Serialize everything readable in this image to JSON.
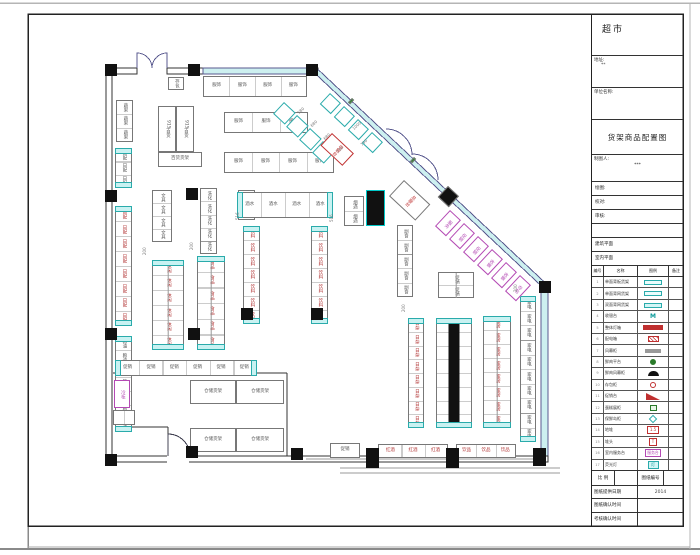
{
  "sheet": {
    "store_type": "超市",
    "address_label": "地址:",
    "address_value": "**",
    "org_label": "单位名称:",
    "org_value": "",
    "drawing_title": "货架商品配置图",
    "drafter_label": "制图人:",
    "drafter_value": "***",
    "rows": [
      {
        "label": "绘图:"
      },
      {
        "label": "校对:"
      },
      {
        "label": "审核:"
      },
      {
        "label": ""
      },
      {
        "label": "建筑平面"
      },
      {
        "label": "室内平面"
      }
    ],
    "scale_label": "比 例",
    "scale_value": "",
    "sheet_no_label": "图纸编号",
    "sheet_no_value": "",
    "date_rows": [
      {
        "label": "图纸提供日期",
        "value": "2014"
      },
      {
        "label": "图纸确认时间",
        "value": ""
      },
      {
        "label": "考核确认时间",
        "value": ""
      }
    ]
  },
  "legend": {
    "headers": [
      "编号",
      "名称",
      "图例",
      "备注"
    ],
    "rows": [
      {
        "no": "1",
        "name": "单面背板货架",
        "sym": "s-rect",
        "symtext": ""
      },
      {
        "no": "2",
        "name": "单面背网货架",
        "sym": "s-rect",
        "symtext": ""
      },
      {
        "no": "3",
        "name": "双面背网货架",
        "sym": "s-rect2",
        "symtext": ""
      },
      {
        "no": "4",
        "name": "收银台",
        "sym": "s-m",
        "symtext": "M"
      },
      {
        "no": "5",
        "name": "整体灯箱",
        "sym": "s-barred",
        "symtext": ""
      },
      {
        "no": "6",
        "name": "配电箱",
        "sym": "s-boxx",
        "symtext": ""
      },
      {
        "no": "7",
        "name": "风幕柜",
        "sym": "s-bargray",
        "symtext": ""
      },
      {
        "no": "8",
        "name": "鲜肉平台",
        "sym": "s-circg",
        "symtext": ""
      },
      {
        "no": "9",
        "name": "鲜肉风幕柜",
        "sym": "s-fan",
        "symtext": ""
      },
      {
        "no": "10",
        "name": "存包柜",
        "sym": "s-circr",
        "symtext": ""
      },
      {
        "no": "11",
        "name": "促销台",
        "sym": "s-wedge",
        "symtext": ""
      },
      {
        "no": "12",
        "name": "蛋糕展柜",
        "sym": "s-boxg",
        "symtext": ""
      },
      {
        "no": "13",
        "name": "保鲜岛柜",
        "sym": "s-diam",
        "symtext": ""
      },
      {
        "no": "14",
        "name": "地堆",
        "sym": "s-box15",
        "symtext": "1.5"
      },
      {
        "no": "15",
        "name": "堆头",
        "sym": "s-boxt",
        "symtext": "T"
      },
      {
        "no": "16",
        "name": "室内服务台",
        "sym": "s-boxm",
        "symtext": "服务台"
      },
      {
        "no": "17",
        "name": "荧光灯",
        "sym": "s-pill",
        "symtext": "灯"
      }
    ]
  },
  "plan": {
    "colors": {
      "cyan": "#2aabab",
      "red": "#c03030",
      "magenta": "#b44ab4",
      "glass": "#cdf0f0",
      "wallline": "#5a5a8f"
    },
    "shelves": [
      {
        "x": 168,
        "y": 77,
        "w": 16,
        "h": 13,
        "label": "存包",
        "n": "locker-unit"
      },
      {
        "x": 203,
        "y": 76,
        "w": 104,
        "h": 21,
        "dir": "h",
        "cells": 4,
        "each": "服饰",
        "n": "apparel-wall-row"
      },
      {
        "x": 116,
        "y": 100,
        "w": 17,
        "h": 42,
        "cells": 3,
        "each": "蔬果",
        "n": "produce-rack"
      },
      {
        "x": 158,
        "y": 106,
        "w": 18,
        "h": 46,
        "label": "915百货",
        "n": "gondola-915"
      },
      {
        "x": 176,
        "y": 106,
        "w": 18,
        "h": 46,
        "label": "915百货",
        "n": "gondola-915"
      },
      {
        "x": 158,
        "y": 152,
        "w": 44,
        "h": 15,
        "dir": "h",
        "label": "百货货架",
        "n": "gondola"
      },
      {
        "x": 224,
        "y": 112,
        "w": 84,
        "h": 21,
        "dir": "h",
        "cells": 3,
        "each": "服饰",
        "n": "apparel-row"
      },
      {
        "x": 224,
        "y": 152,
        "w": 110,
        "h": 21,
        "dir": "h",
        "cells": 4,
        "each": "服饰",
        "n": "apparel-row"
      },
      {
        "x": 115,
        "y": 148,
        "w": 17,
        "h": 40,
        "cells": 3,
        "each": "日配",
        "cap": 1,
        "n": "wall-run"
      },
      {
        "x": 115,
        "y": 206,
        "w": 17,
        "h": 120,
        "cells": 8,
        "each": "日配",
        "cap": 1,
        "lc": "#b03030",
        "n": "wall-run"
      },
      {
        "x": 115,
        "y": 336,
        "w": 17,
        "h": 96,
        "cells": 7,
        "each": "粮油",
        "cap": 1,
        "n": "wall-run"
      },
      {
        "x": 152,
        "y": 190,
        "w": 20,
        "h": 52,
        "cells": 4,
        "each": "文具",
        "n": "gondola"
      },
      {
        "x": 238,
        "y": 190,
        "w": 17,
        "h": 30,
        "cells": 2,
        "each": "玩具",
        "n": "gondola"
      },
      {
        "x": 200,
        "y": 188,
        "w": 17,
        "h": 66,
        "cells": 5,
        "each": "洗化",
        "n": "gondola"
      },
      {
        "x": 152,
        "y": 260,
        "w": 32,
        "h": 90,
        "cells": 6,
        "dbl": 1,
        "cap": 1,
        "each": "休闲",
        "lc": "#b03030",
        "n": "gondola-double"
      },
      {
        "x": 197,
        "y": 256,
        "w": 28,
        "h": 94,
        "cells": 6,
        "dbl": 1,
        "cap": 1,
        "each": "食品",
        "lc": "#b03030",
        "n": "gondola-double"
      },
      {
        "x": 237,
        "y": 192,
        "w": 96,
        "h": 26,
        "dir": "h",
        "cells": 4,
        "cap": 1,
        "each": "酒水",
        "n": "gondola-top-bar"
      },
      {
        "x": 243,
        "y": 226,
        "w": 17,
        "h": 98,
        "cells": 7,
        "cap": 1,
        "each": "饮料",
        "lc": "#b03030",
        "n": "gondola"
      },
      {
        "x": 311,
        "y": 226,
        "w": 17,
        "h": 98,
        "cells": 7,
        "cap": 1,
        "each": "饮料",
        "lc": "#b03030",
        "n": "gondola"
      },
      {
        "x": 397,
        "y": 225,
        "w": 16,
        "h": 72,
        "cells": 5,
        "each": "副食",
        "n": "gondola"
      },
      {
        "x": 438,
        "y": 272,
        "w": 36,
        "h": 26,
        "cells": 2,
        "dbl": 1,
        "each": "促销",
        "n": "promo-table"
      },
      {
        "x": 408,
        "y": 318,
        "w": 16,
        "h": 110,
        "cells": 8,
        "cap": 1,
        "each": "日杂",
        "lc": "#b03030",
        "n": "gondola"
      },
      {
        "x": 436,
        "y": 318,
        "w": 36,
        "h": 110,
        "cells": 8,
        "dbl": 1,
        "mid": "black",
        "cap": 1,
        "each": "五金",
        "lc": "#b03030",
        "n": "gondola-column-run"
      },
      {
        "x": 483,
        "y": 316,
        "w": 28,
        "h": 112,
        "cells": 8,
        "dbl": 1,
        "cap": 1,
        "each": "家居",
        "lc": "#b03030",
        "n": "gondola-double"
      },
      {
        "x": 520,
        "y": 296,
        "w": 16,
        "h": 146,
        "cells": 10,
        "cap": 1,
        "each": "家电",
        "n": "wall-run-right"
      },
      {
        "x": 115,
        "y": 360,
        "w": 142,
        "h": 16,
        "dir": "h",
        "cells": 6,
        "cap": 1,
        "each": "促销",
        "n": "back-row"
      },
      {
        "x": 378,
        "y": 444,
        "w": 70,
        "h": 14,
        "dir": "h",
        "cells": 3,
        "each": "红酒",
        "lc": "#b03030",
        "n": "bottom-row"
      },
      {
        "x": 456,
        "y": 444,
        "w": 60,
        "h": 14,
        "dir": "h",
        "cells": 3,
        "each": "饮品",
        "lc": "#b03030",
        "n": "bottom-row"
      },
      {
        "x": 330,
        "y": 443,
        "w": 30,
        "h": 15,
        "dir": "h",
        "label": "促销",
        "n": "bottom-unit"
      },
      {
        "x": 190,
        "y": 380,
        "w": 46,
        "h": 24,
        "dir": "h",
        "label": "仓储货架",
        "n": "storage-rack"
      },
      {
        "x": 236,
        "y": 380,
        "w": 48,
        "h": 24,
        "dir": "h",
        "label": "仓储货架",
        "n": "storage-rack"
      },
      {
        "x": 190,
        "y": 428,
        "w": 46,
        "h": 24,
        "dir": "h",
        "label": "仓储货架",
        "n": "storage-rack"
      },
      {
        "x": 236,
        "y": 428,
        "w": 48,
        "h": 24,
        "dir": "h",
        "label": "仓储货架",
        "n": "storage-rack"
      },
      {
        "x": 114,
        "y": 380,
        "w": 16,
        "h": 28,
        "label": "冷柜",
        "bc": "#b44ab4",
        "lc": "#b44ab4",
        "n": "cold-cabinet"
      },
      {
        "x": 113,
        "y": 410,
        "w": 22,
        "h": 15,
        "dir": "h",
        "cells": 2,
        "n": "small-unit"
      },
      {
        "x": 366,
        "y": 190,
        "w": 19,
        "h": 36,
        "fill": "#111",
        "bc": "#00c8c8",
        "n": "freezer-island"
      },
      {
        "x": 344,
        "y": 196,
        "w": 20,
        "h": 30,
        "cells": 2,
        "each": "烟酒",
        "n": "tobacco-case"
      },
      {
        "x": 330,
        "y": 93,
        "w": 15,
        "h": 15,
        "rot": 43,
        "bc": "#2aabab",
        "n": "diagonal-case"
      },
      {
        "x": 344,
        "y": 106,
        "w": 15,
        "h": 15,
        "rot": 43,
        "bc": "#2aabab",
        "n": "diagonal-case"
      },
      {
        "x": 358,
        "y": 119,
        "w": 15,
        "h": 15,
        "rot": 43,
        "bc": "#2aabab",
        "n": "diagonal-case"
      },
      {
        "x": 372,
        "y": 132,
        "w": 15,
        "h": 15,
        "rot": 43,
        "bc": "#2aabab",
        "n": "diagonal-case"
      },
      {
        "x": 284,
        "y": 102,
        "w": 16,
        "h": 16,
        "rot": 43,
        "bc": "#2aabab",
        "n": "diagonal-island"
      },
      {
        "x": 297,
        "y": 115,
        "w": 16,
        "h": 16,
        "rot": 43,
        "bc": "#2aabab",
        "n": "diagonal-island"
      },
      {
        "x": 310,
        "y": 128,
        "w": 16,
        "h": 16,
        "rot": 43,
        "bc": "#2aabab",
        "n": "diagonal-island"
      },
      {
        "x": 323,
        "y": 141,
        "w": 16,
        "h": 16,
        "rot": 43,
        "bc": "#2aabab",
        "n": "diagonal-island"
      },
      {
        "x": 332,
        "y": 133,
        "w": 30,
        "h": 17,
        "rot": 43,
        "bc": "#c03030",
        "label": "收银台",
        "lc": "#c03030",
        "n": "checkout-counter"
      },
      {
        "x": 404,
        "y": 180,
        "w": 36,
        "h": 22,
        "rot": 43,
        "label": "总服台",
        "lc": "#c03030",
        "n": "service-desk"
      },
      {
        "x": 448,
        "y": 186,
        "w": 15,
        "h": 15,
        "rot": 43,
        "fill": "#111",
        "n": "column-diagonal"
      },
      {
        "x": 450,
        "y": 210,
        "w": 15,
        "h": 22,
        "rot": 43,
        "bc": "#b44ab4",
        "label": "服务",
        "lc": "#b44ab4",
        "n": "diagonal-service"
      },
      {
        "x": 464,
        "y": 223,
        "w": 15,
        "h": 22,
        "rot": 43,
        "bc": "#b44ab4",
        "label": "促销",
        "lc": "#b44ab4",
        "n": "diagonal-service"
      },
      {
        "x": 478,
        "y": 236,
        "w": 15,
        "h": 22,
        "rot": 43,
        "bc": "#b44ab4",
        "label": "促销",
        "lc": "#b44ab4",
        "n": "diagonal-service"
      },
      {
        "x": 492,
        "y": 249,
        "w": 15,
        "h": 22,
        "rot": 43,
        "bc": "#b44ab4",
        "label": "收银",
        "lc": "#b44ab4",
        "n": "diagonal-service"
      },
      {
        "x": 506,
        "y": 262,
        "w": 15,
        "h": 22,
        "rot": 43,
        "bc": "#b44ab4",
        "label": "收银",
        "lc": "#b44ab4",
        "n": "diagonal-service"
      },
      {
        "x": 520,
        "y": 275,
        "w": 15,
        "h": 22,
        "rot": 43,
        "bc": "#b44ab4",
        "label": "存包",
        "lc": "#b44ab4",
        "n": "diagonal-service"
      },
      {
        "x": 352,
        "y": 98,
        "w": 3,
        "h": 6,
        "rot": 43,
        "fill": "#2a8a2a",
        "n": "door-sensor"
      },
      {
        "x": 414,
        "y": 157,
        "w": 3,
        "h": 6,
        "rot": 43,
        "fill": "#2a8a2a",
        "n": "door-sensor"
      }
    ],
    "columns": [
      [
        105,
        64
      ],
      [
        188,
        64
      ],
      [
        306,
        64
      ],
      [
        539,
        281
      ],
      [
        105,
        190
      ],
      [
        105,
        328
      ],
      [
        188,
        328
      ],
      [
        186,
        188
      ],
      [
        241,
        308
      ],
      [
        311,
        308
      ],
      [
        105,
        454
      ],
      [
        186,
        446
      ],
      [
        291,
        448
      ],
      [
        366,
        448,
        13,
        20
      ],
      [
        446,
        448,
        13,
        20
      ],
      [
        533,
        448,
        13,
        18
      ]
    ],
    "texts": [
      {
        "t": "580",
        "x": 297,
        "y": 112,
        "rot": -43
      },
      {
        "t": "680",
        "x": 310,
        "y": 125,
        "rot": -43
      },
      {
        "t": "680",
        "x": 323,
        "y": 138,
        "rot": -43
      },
      {
        "t": "730",
        "x": 336,
        "y": 151,
        "rot": -43
      },
      {
        "t": "1000",
        "x": 352,
        "y": 128,
        "rot": -43
      },
      {
        "t": "750",
        "x": 360,
        "y": 144,
        "rot": -43
      },
      {
        "t": "200",
        "x": 143,
        "y": 255,
        "rot": -90
      },
      {
        "t": "200",
        "x": 190,
        "y": 250,
        "rot": -90
      },
      {
        "t": "516",
        "x": 236,
        "y": 220,
        "rot": -90
      },
      {
        "t": "516",
        "x": 330,
        "y": 222,
        "rot": -90
      },
      {
        "t": "200",
        "x": 402,
        "y": 312,
        "rot": -90
      },
      {
        "t": "200",
        "x": 514,
        "y": 292,
        "rot": -90
      }
    ]
  }
}
